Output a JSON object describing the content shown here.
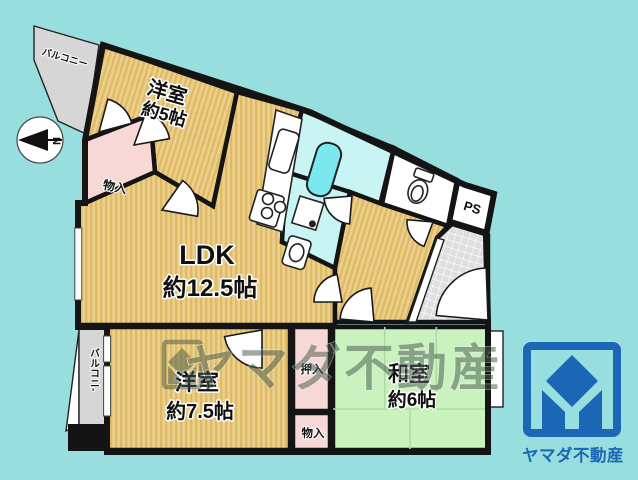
{
  "colors": {
    "background": "#98dede",
    "wall": "#141414",
    "wood_floor": "#ebcf8c",
    "wood_stripe": "#dfb964",
    "tatami_green": "#c9f2bf",
    "tatami_line": "#a8df9e",
    "closet_pink": "#f8d7d7",
    "bath_floor": "#c9f4f4",
    "bathtub_cyan": "#7ae8ee",
    "balcony_gray": "#d6d6d6",
    "entrance_tile_gray": "#dedede",
    "fixture_white": "#ffffff",
    "brand_blue": "#1b67b6",
    "watermark_green": "#44584a"
  },
  "plan": {
    "compass_label": "N",
    "balcony_top_label": "バルコニー",
    "balcony_left_label": "バルコニ-",
    "ps_label": "PS",
    "rooms": {
      "youshitsu5": {
        "name": "洋室",
        "size": "約5帖"
      },
      "ldk": {
        "name": "LDK",
        "size": "約12.5帖"
      },
      "youshitsu75": {
        "name": "洋室",
        "size": "約7.5帖"
      },
      "washitsu6": {
        "name": "和室",
        "size": "約6帖"
      }
    },
    "storage": {
      "top": "物入",
      "oshiire": "押入",
      "bottom": "物入"
    }
  },
  "watermark": {
    "text": "ヤマダ不動産"
  },
  "brand": {
    "name": "ヤマダ不動産"
  }
}
